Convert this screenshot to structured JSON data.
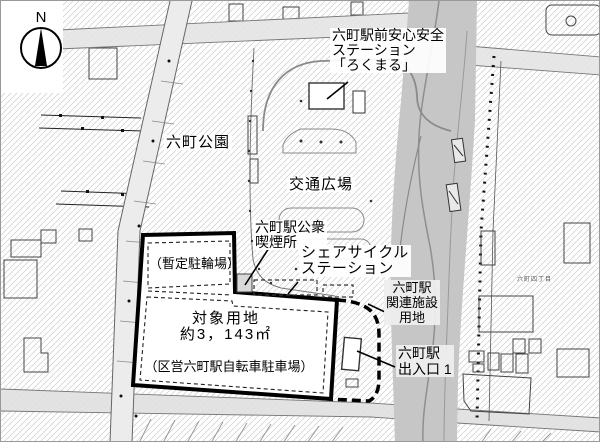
{
  "compass": {
    "label": "N"
  },
  "labels": {
    "safety_station": [
      "六町駅前安心安全",
      "ステーション",
      "「ろくまる」"
    ],
    "park": "六町公園",
    "plaza": "交通広場",
    "smoking_area": [
      "六町駅公衆",
      "喫煙所"
    ],
    "share_cycle": [
      "シェアサイクル",
      "ステーション"
    ],
    "temporary_bicycle_parking": "（暫定駐輪場）",
    "target_site": {
      "name": "対象用地",
      "area": "約3，143㎡",
      "note": "（区営六町駅自転車駐車場）"
    },
    "related_facility": [
      "六町駅",
      "関連施設",
      "用地"
    ],
    "station_exit": [
      "六町駅",
      "出入口 1"
    ],
    "district": "六町四丁目"
  },
  "colors": {
    "main_road_gray": "#c6c6c6",
    "minor_road_gray": "#e4e4e4",
    "hatch_line": "#cccccc",
    "site_boundary": "#000000",
    "building_line": "#444444"
  }
}
